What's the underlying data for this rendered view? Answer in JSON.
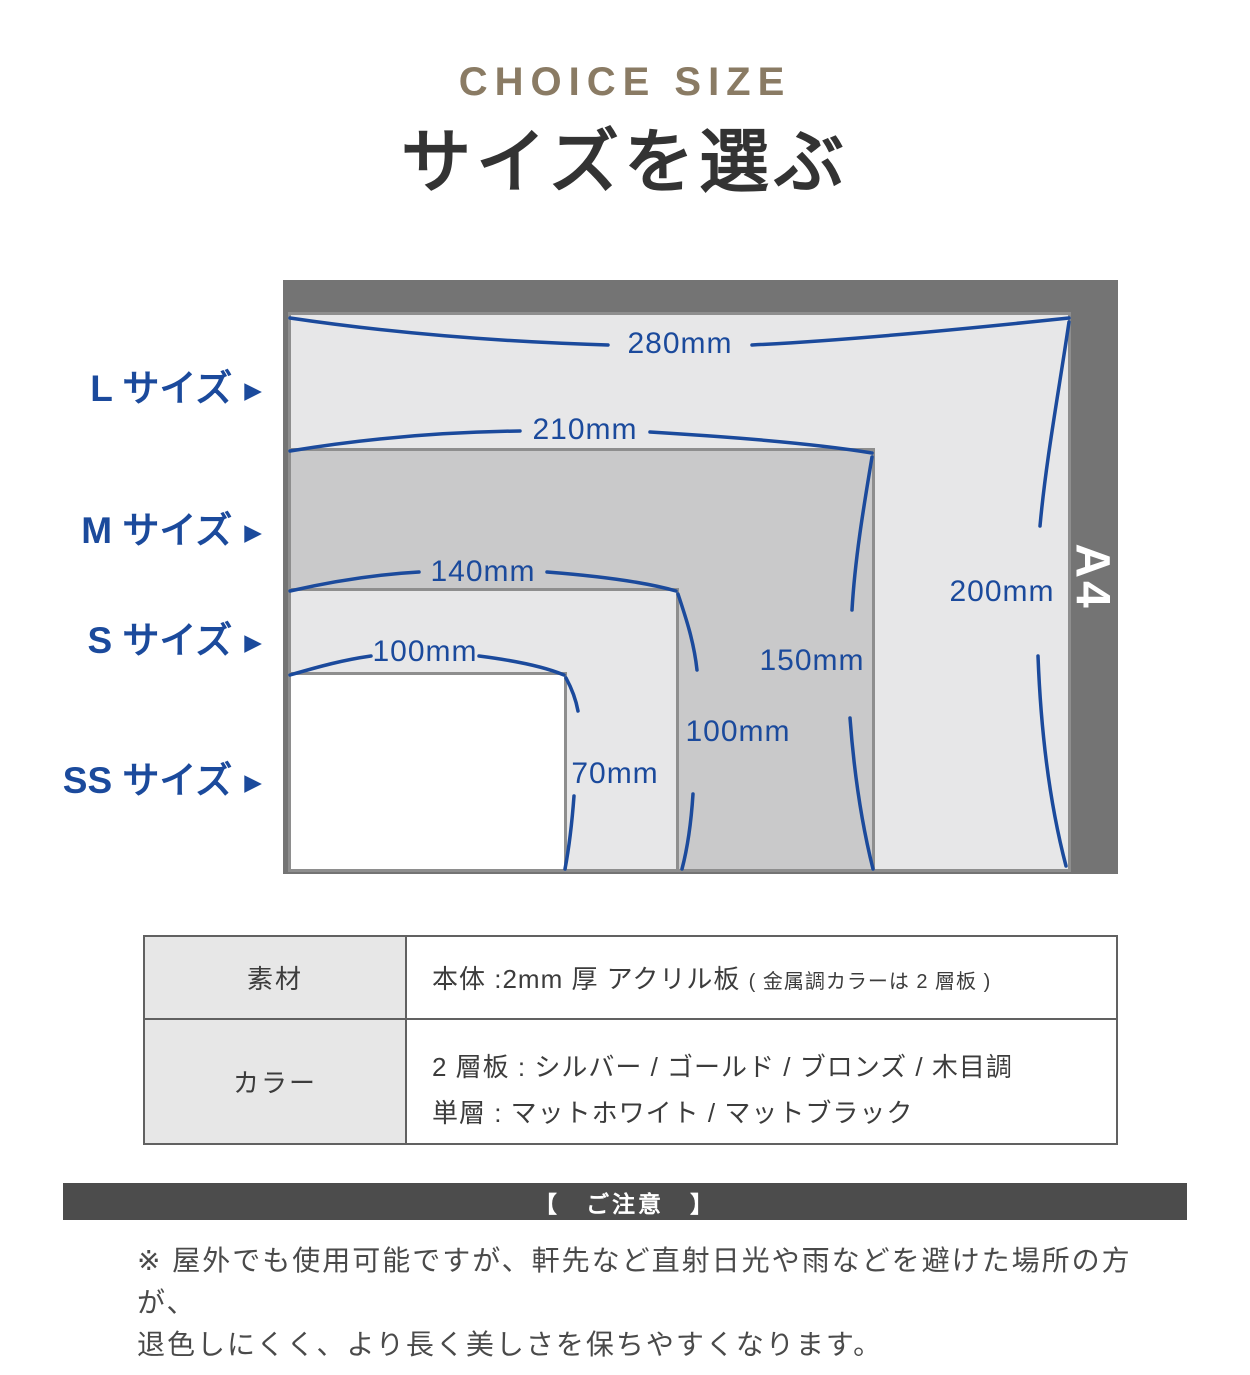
{
  "header": {
    "title_en": "CHOICE SIZE",
    "title_ja": "サイズを選ぶ"
  },
  "diagram": {
    "frame_label": "A4",
    "arrow": "▶",
    "sizes": [
      {
        "name": "L サイズ",
        "width": "280mm",
        "height": "200mm"
      },
      {
        "name": "M サイズ",
        "width": "210mm",
        "height": "150mm"
      },
      {
        "name": "S サイズ",
        "width": "140mm",
        "height": "100mm"
      },
      {
        "name": "SS サイズ",
        "width": "100mm",
        "height": "70mm"
      }
    ]
  },
  "spec_table": {
    "rows": [
      {
        "label": "素材",
        "value_main": "本体 :2mm 厚 アクリル板",
        "value_note": "( 金属調カラーは 2 層板 )"
      },
      {
        "label": "カラー",
        "line1": "2 層板 : シルバー / ゴールド / ブロンズ / 木目調",
        "line2": "単層 : マットホワイト / マットブラック"
      }
    ]
  },
  "caution": {
    "banner": "【　ご注意　】",
    "line1": "※ 屋外でも使用可能ですが、軒先など直射日光や雨などを避けた場所の方が、",
    "line2": "退色しにくく、より長く美しさを保ちやすくなります。"
  },
  "colors": {
    "accent_blue": "#1b4a9c",
    "title_brown": "#8a7b64",
    "frame_gray": "#747474",
    "banner_gray": "#4c4c4c"
  }
}
